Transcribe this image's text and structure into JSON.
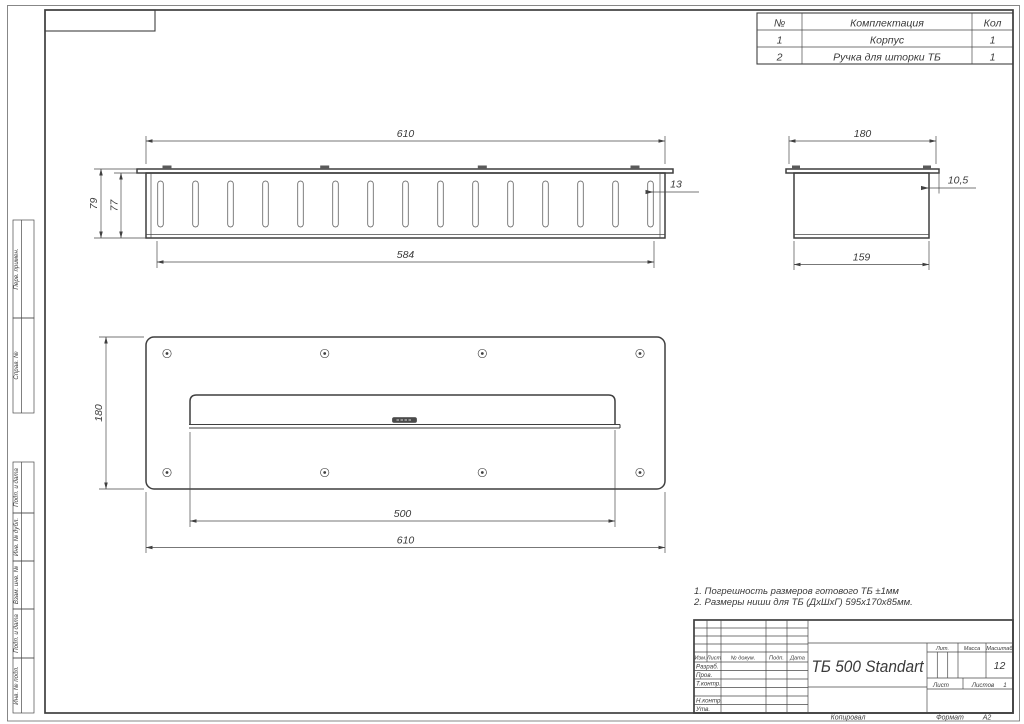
{
  "colors": {
    "background": "#ffffff",
    "line": "#3f3f3f",
    "text": "#3a3a3a"
  },
  "parts_table": {
    "header": {
      "no": "№",
      "name": "Комплектация",
      "qty": "Кол"
    },
    "rows": [
      {
        "no": "1",
        "name": "Корпус",
        "qty": "1"
      },
      {
        "no": "2",
        "name": "Ручка для шторки ТБ",
        "qty": "1"
      }
    ]
  },
  "views": {
    "top": {
      "dim_width": "610",
      "dim_height_outer": "79",
      "dim_height_inner": "77",
      "dim_inner_width": "584",
      "dim_edge": "13"
    },
    "side": {
      "dim_width": "180",
      "dim_flange": "10,5",
      "dim_body": "159"
    },
    "front": {
      "dim_height": "180",
      "dim_slot": "500",
      "dim_width": "610"
    }
  },
  "notes": {
    "line1": "1. Погрешность размеров готового ТБ ±1мм",
    "line2": "2. Размеры ниши для ТБ (ДхШхГ) 595х170х85мм."
  },
  "title_block": {
    "doc_title": "ТБ 500 Standart",
    "col_izm": "Изм.",
    "col_list": "Лист",
    "col_doc": "№ докум.",
    "col_podp": "Подп.",
    "col_data": "Дата",
    "row_razrab": "Разраб.",
    "row_prov": "Пров.",
    "row_tkontr": "Т.контр.",
    "row_nkontr": "Н.контр.",
    "row_utv": "Утв.",
    "lit": "Лит.",
    "massa": "Масса",
    "masshtab": "Масштаб",
    "scale_value": "12",
    "list": "Лист",
    "listov": "Листов",
    "listov_value": "1",
    "kopiroval": "Копировал",
    "format": "Формат",
    "format_value": "А2"
  },
  "margin": {
    "perv": "Перв. примен.",
    "sprav": "Справ. №",
    "podp1": "Подп. и дата",
    "inv_dubl": "Инв. № дубл.",
    "vzam": "Взам. инв. №",
    "podp2": "Подп. и дата",
    "inv_podl": "Инв. № подл."
  }
}
